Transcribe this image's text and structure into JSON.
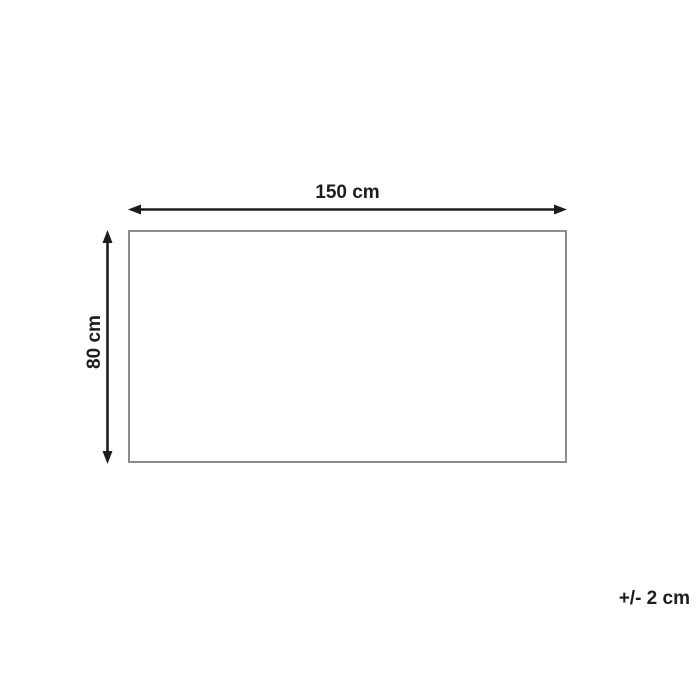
{
  "diagram": {
    "width_label": "150 cm",
    "height_label": "80 cm",
    "tolerance_label": "+/- 2 cm",
    "colors": {
      "arrow": "#1d1d1b",
      "text": "#1d1d1b",
      "outline": "#8c8c8c",
      "background": "#ffffff"
    }
  }
}
